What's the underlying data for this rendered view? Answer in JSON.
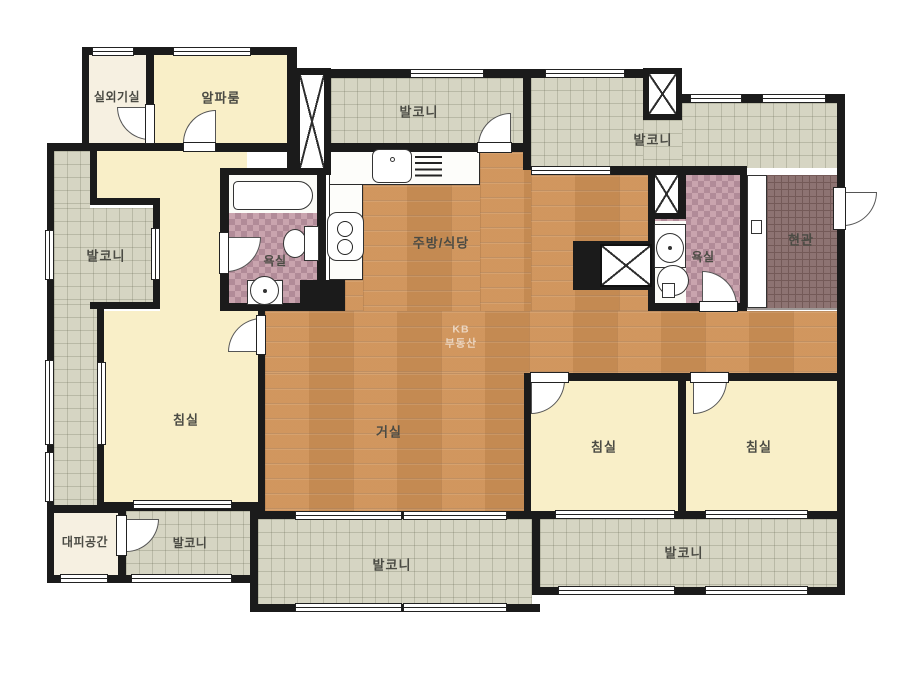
{
  "watermark": {
    "line1": "KB",
    "line2": "부동산"
  },
  "rooms": [
    {
      "id": "outdoor-unit-room",
      "label": "실외기실"
    },
    {
      "id": "alpha-room",
      "label": "알파룸"
    },
    {
      "id": "balcony-top",
      "label": "발코니"
    },
    {
      "id": "balcony-top-right",
      "label": "발코니"
    },
    {
      "id": "balcony-left",
      "label": "발코니"
    },
    {
      "id": "bathroom-left",
      "label": "욕실"
    },
    {
      "id": "kitchen-dining",
      "label": "주방/식당"
    },
    {
      "id": "bathroom-right",
      "label": "욕실"
    },
    {
      "id": "entrance",
      "label": "현관"
    },
    {
      "id": "bedroom-left",
      "label": "침실"
    },
    {
      "id": "living-room",
      "label": "거실"
    },
    {
      "id": "bedroom-center",
      "label": "침실"
    },
    {
      "id": "bedroom-right",
      "label": "침실"
    },
    {
      "id": "evacuation-space",
      "label": "대피공간"
    },
    {
      "id": "balcony-bottom-left",
      "label": "발코니"
    },
    {
      "id": "balcony-bottom",
      "label": "발코니"
    },
    {
      "id": "balcony-bottom-right",
      "label": "발코니"
    }
  ],
  "colors": {
    "wall": "#1b1b1b",
    "wood": "#cf9156",
    "balcony_tile": "#d6d5c3",
    "bathroom_tile": "#c9a4ae",
    "bathroom_tile_dark": "#b18b98",
    "entrance_tile": "#8d7372",
    "entrance_line": "#745a58",
    "room_yellow": "#f9efc8",
    "room_cream": "#f6f0e1",
    "label": "#4b4b44",
    "watermark": "#ffffff"
  }
}
